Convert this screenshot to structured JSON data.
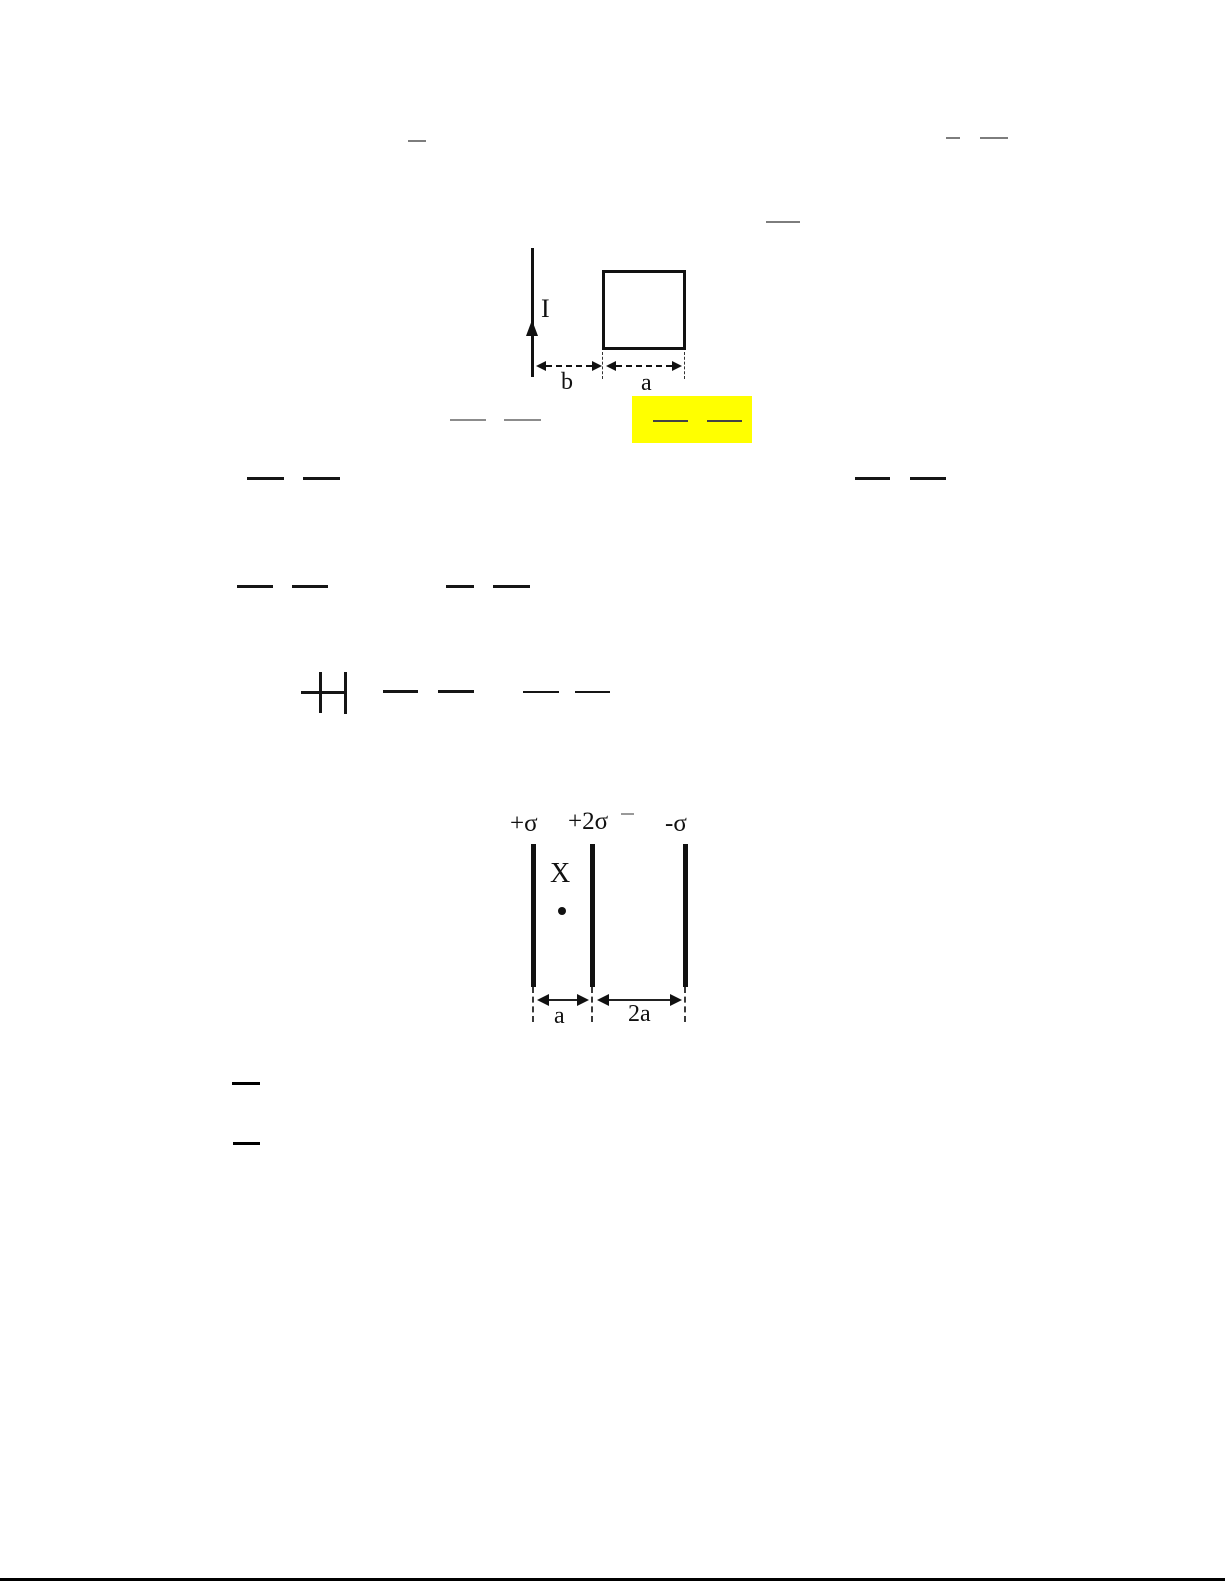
{
  "page": {
    "width": 1225,
    "height": 1585,
    "background": "#ffffff"
  },
  "highlight": {
    "color": "#ffff00"
  },
  "figure1": {
    "current_label": "I",
    "dim_b_label": "b",
    "dim_a_label": "a"
  },
  "figure2": {
    "sheet_labels": [
      "+σ",
      "+2σ",
      "-σ"
    ],
    "point_label": "X",
    "dim_a_label": "a",
    "dim_2a_label": "2a"
  },
  "marks": {
    "horizontal_bars": [
      {
        "x": 408,
        "y": 140,
        "w": 18,
        "h": 2,
        "color": "#7d7d7d"
      },
      {
        "x": 946,
        "y": 137,
        "w": 14,
        "h": 2,
        "color": "#7d7d7d"
      },
      {
        "x": 980,
        "y": 137,
        "w": 28,
        "h": 2,
        "color": "#7d7d7d"
      },
      {
        "x": 766,
        "y": 221,
        "w": 34,
        "h": 2,
        "color": "#7d7d7d"
      },
      {
        "x": 450,
        "y": 419,
        "w": 36,
        "h": 2,
        "color": "#8c8c8c"
      },
      {
        "x": 504,
        "y": 419,
        "w": 37,
        "h": 2,
        "color": "#8c8c8c"
      },
      {
        "x": 653,
        "y": 420,
        "w": 35,
        "h": 2,
        "color": "#444444"
      },
      {
        "x": 707,
        "y": 420,
        "w": 35,
        "h": 2,
        "color": "#444444"
      },
      {
        "x": 247,
        "y": 477,
        "w": 37,
        "h": 3,
        "color": "#151515"
      },
      {
        "x": 303,
        "y": 477,
        "w": 37,
        "h": 3,
        "color": "#151515"
      },
      {
        "x": 855,
        "y": 477,
        "w": 35,
        "h": 3,
        "color": "#151515"
      },
      {
        "x": 910,
        "y": 477,
        "w": 36,
        "h": 3,
        "color": "#151515"
      },
      {
        "x": 237,
        "y": 585,
        "w": 36,
        "h": 3,
        "color": "#151515"
      },
      {
        "x": 292,
        "y": 585,
        "w": 36,
        "h": 3,
        "color": "#151515"
      },
      {
        "x": 446,
        "y": 585,
        "w": 28,
        "h": 3,
        "color": "#151515"
      },
      {
        "x": 493,
        "y": 585,
        "w": 37,
        "h": 3,
        "color": "#151515"
      },
      {
        "x": 301,
        "y": 691,
        "w": 18,
        "h": 3,
        "color": "#151515"
      },
      {
        "x": 322,
        "y": 691,
        "w": 22,
        "h": 3,
        "color": "#151515"
      },
      {
        "x": 383,
        "y": 690,
        "w": 35,
        "h": 3,
        "color": "#151515"
      },
      {
        "x": 438,
        "y": 690,
        "w": 36,
        "h": 3,
        "color": "#151515"
      },
      {
        "x": 523,
        "y": 691,
        "w": 36,
        "h": 2,
        "color": "#151515"
      },
      {
        "x": 575,
        "y": 691,
        "w": 35,
        "h": 2,
        "color": "#151515"
      },
      {
        "x": 621,
        "y": 813,
        "w": 13,
        "h": 2,
        "color": "#999999"
      },
      {
        "x": 232,
        "y": 1082,
        "w": 28,
        "h": 3,
        "color": "#000000"
      },
      {
        "x": 233,
        "y": 1142,
        "w": 27,
        "h": 3,
        "color": "#000000"
      },
      {
        "x": 0,
        "y": 1578,
        "w": 1225,
        "h": 3,
        "color": "#000000"
      }
    ],
    "vertical_bars": [
      {
        "x": 319,
        "y": 672,
        "w": 2.5,
        "h": 41,
        "color": "#151515"
      },
      {
        "x": 344,
        "y": 672,
        "w": 2.5,
        "h": 42,
        "color": "#151515"
      }
    ]
  }
}
